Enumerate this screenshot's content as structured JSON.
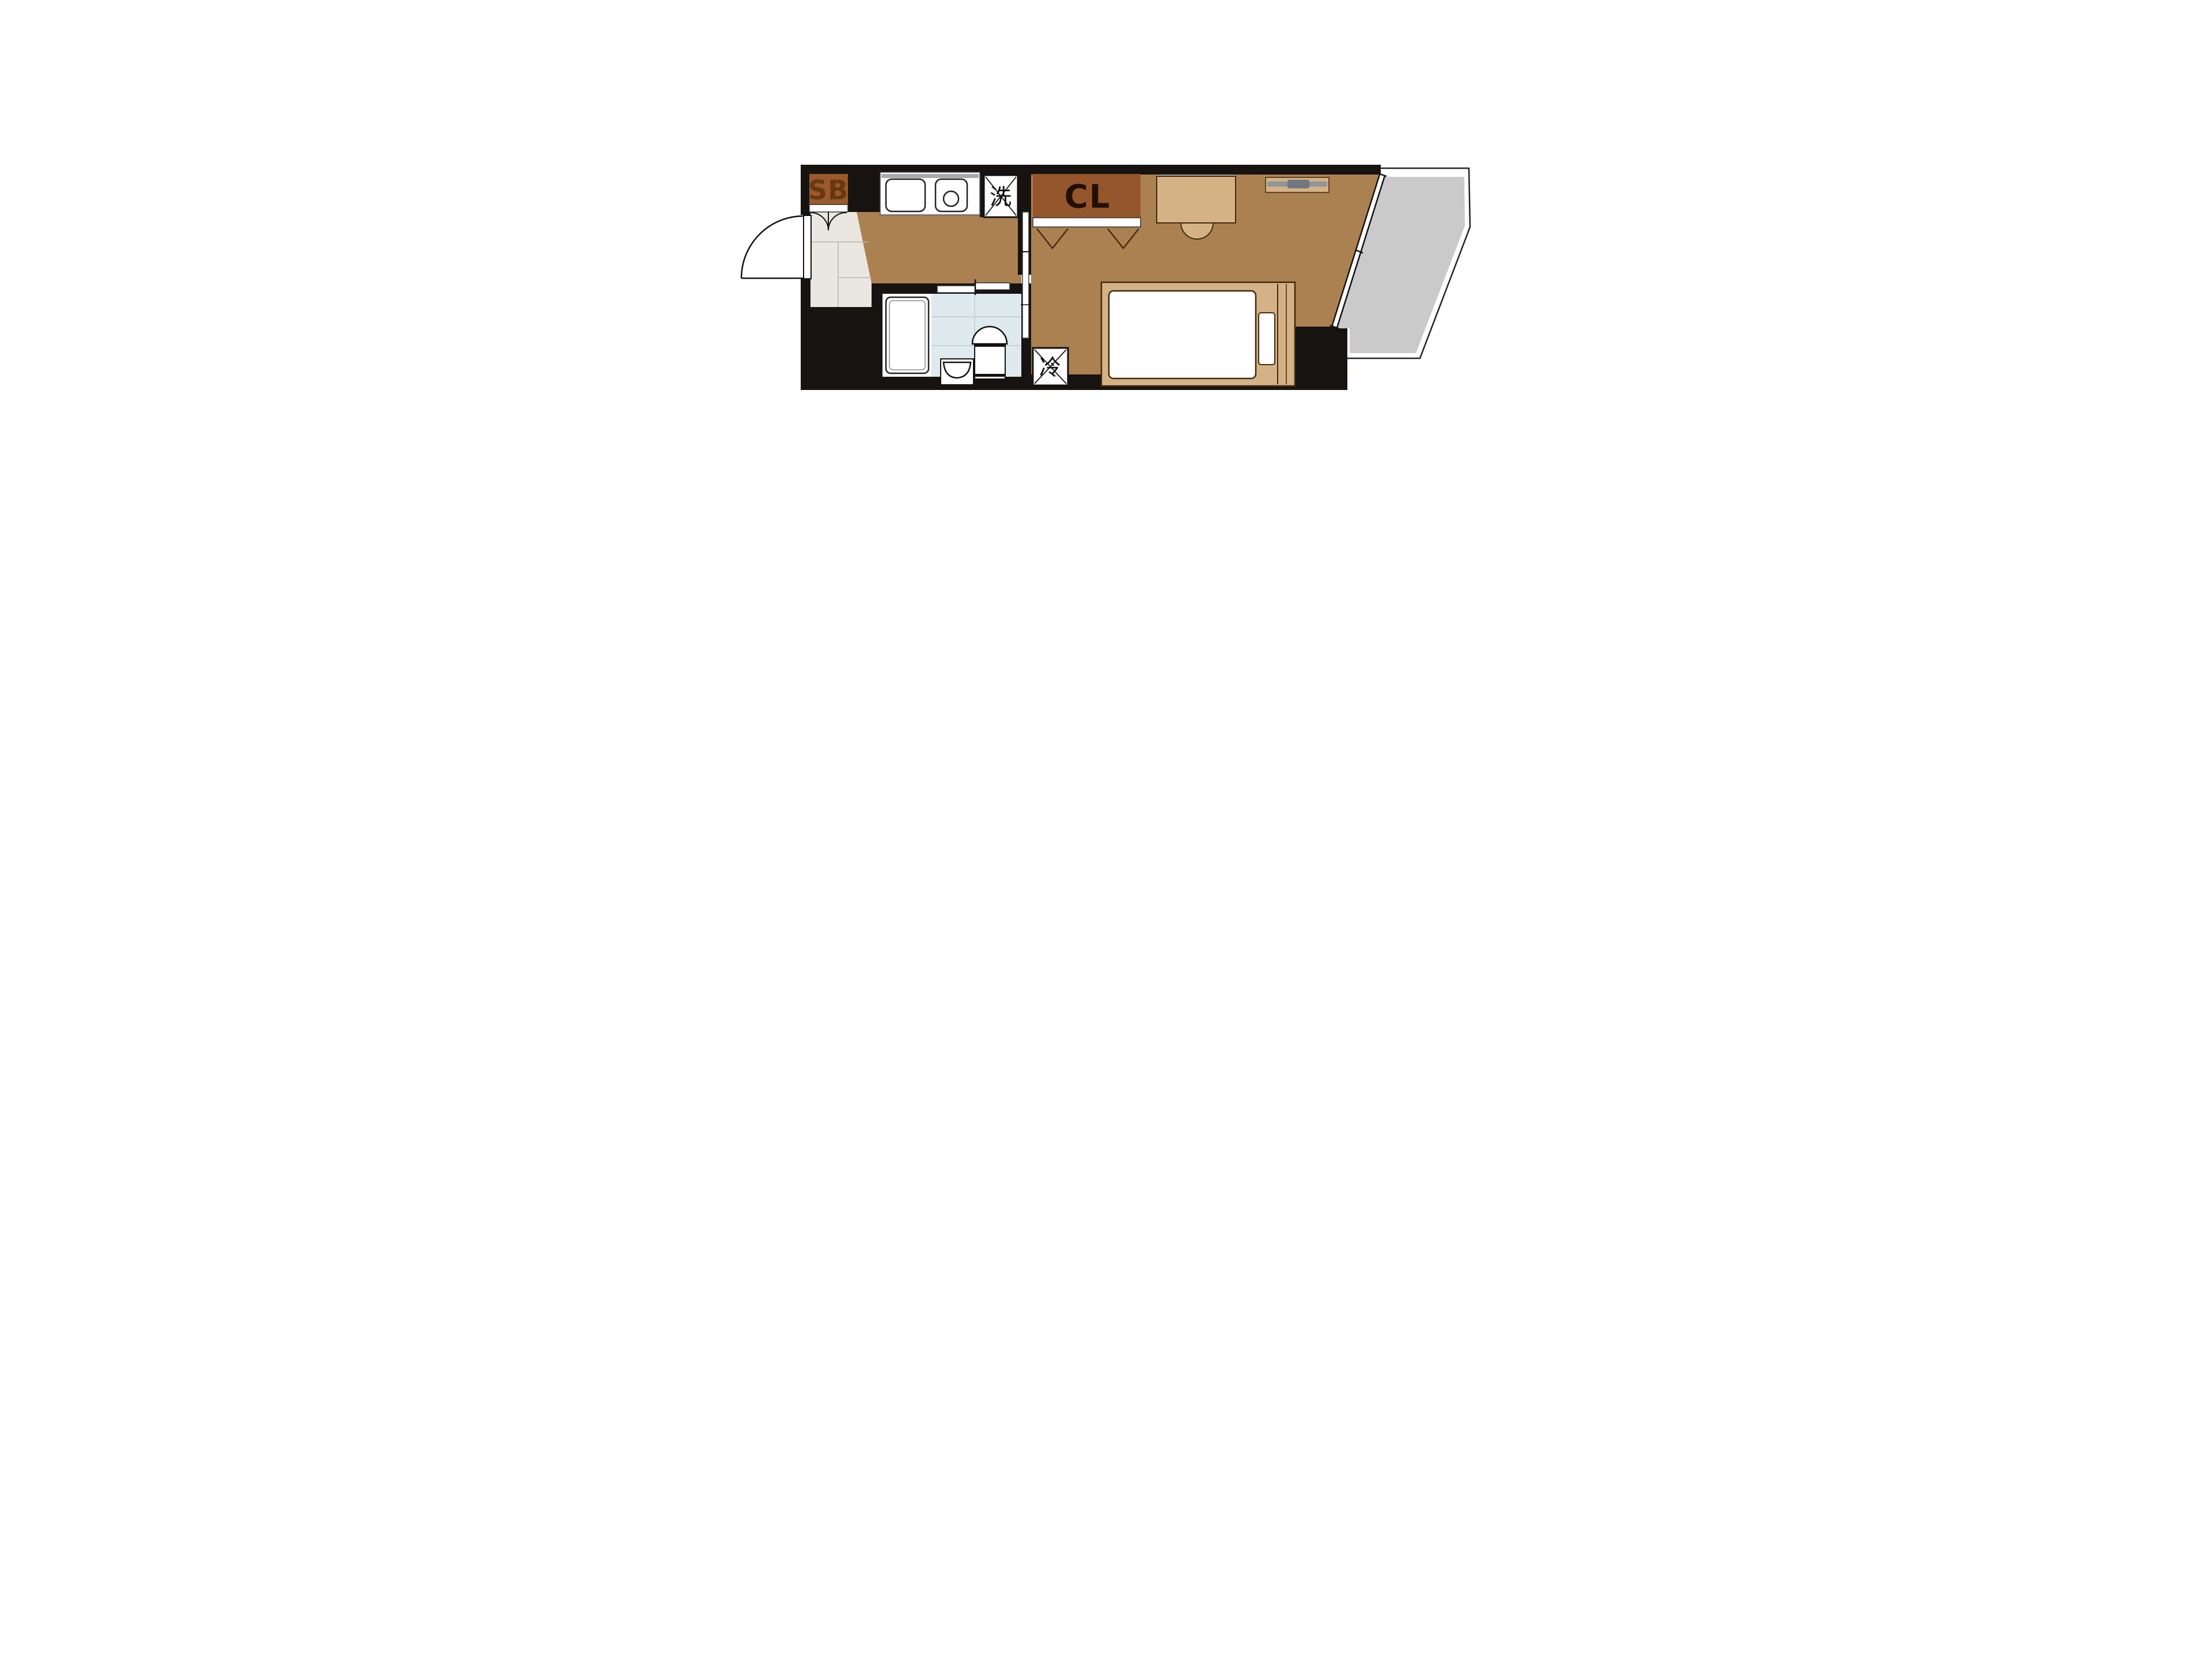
{
  "labels": {
    "shoe_box": "SB",
    "closet": "CL",
    "washing_machine": "洗",
    "refrigerator": "冷"
  },
  "colors": {
    "wall": "#171310",
    "wood": "#ac8151",
    "genkan": "#eae7e0",
    "tile": "#dfeaee",
    "balcony": "#cacaca",
    "sb": "#9a5a2d",
    "sb_text": "#693811",
    "cl": "#95562c",
    "cl_text": "#201004",
    "tan": "#d5b285",
    "outline": "#41290e",
    "white": "#ffffff",
    "gray_bar": "#8e969c",
    "gray_bar_dark": "#70787f",
    "grid_genkan": "#b9b5ac",
    "grid_tile": "#b7ccd4",
    "shadow": "#a9a9a9",
    "line": "#111111"
  }
}
